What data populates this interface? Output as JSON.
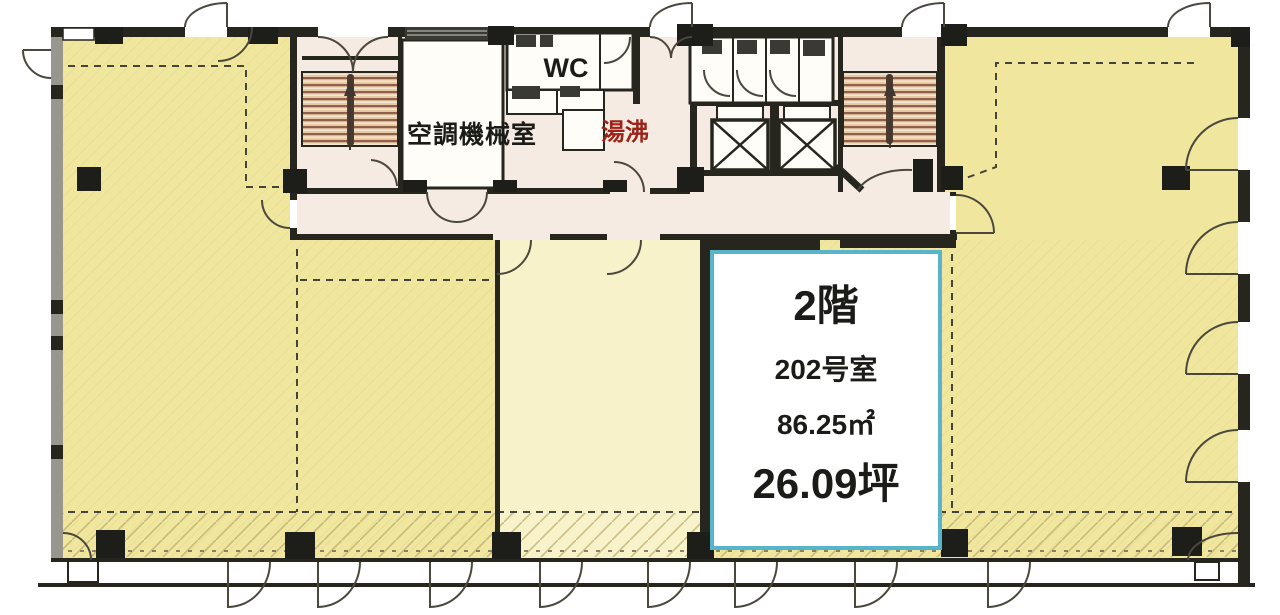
{
  "floor_plan": {
    "unit_202": {
      "floor": "2階",
      "room_number": "202号室",
      "area_sqm": "86.25㎡",
      "area_tsubo": "26.09坪"
    },
    "labels": {
      "wc": "WC",
      "hvac_room": "空調機械室",
      "hot_water": "湯沸"
    },
    "colors": {
      "open_area": "#f0e69e",
      "pale_area": "#f8f2cb",
      "core_area": "#f6ebe2",
      "wall": "#26261f",
      "column": "#1d1d1a",
      "unit_border": "#58b4c8",
      "unit_fill": "#ffffff",
      "stair_fill": "#e7c9a4",
      "stair_stripe": "#8f5f4a",
      "hot_water_text": "#9b2318"
    }
  }
}
